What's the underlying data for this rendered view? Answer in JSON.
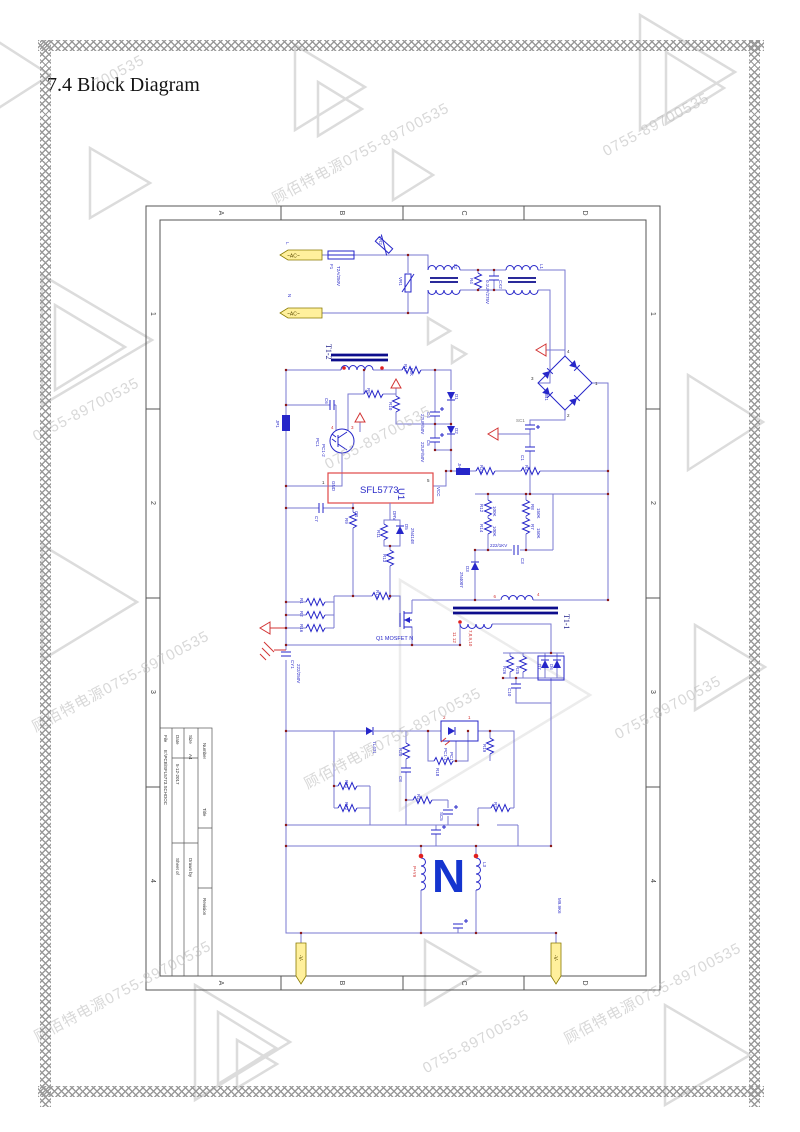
{
  "page": {
    "title": "7.4 Block Diagram"
  },
  "watermark": {
    "text": "顾佰特电源0755-89700535",
    "short": "0755-89700535",
    "frag": "700535"
  },
  "frame": {
    "cols": [
      "A",
      "B",
      "C",
      "D"
    ],
    "rows": [
      "1",
      "2",
      "3",
      "4"
    ]
  },
  "title_block": {
    "title_label": "Title",
    "size_label": "Size",
    "size": "A4",
    "number_label": "Number",
    "revision_label": "Revision",
    "date_label": "Date",
    "date": "5-12-2017",
    "sheet_label": "Sheet of",
    "file_label": "File",
    "file": "E:\\PCB\\SFL5773.SCHDOC",
    "drawn_label": "Drawn by"
  },
  "sch": {
    "acL": "L",
    "acN": "N",
    "ac": "~AC~",
    "f1": "F1",
    "f1v": "T2A/250V",
    "vr2": "VR2",
    "vr1": "VR1",
    "l2": "L2",
    "r4": "R4",
    "cx2": "CX2",
    "cx2v": "0.1UF/275V",
    "l1": "L1",
    "db1": "DB1",
    "bp1": "1",
    "bp2": "2",
    "bp3": "3",
    "bp4": "4",
    "sc1": "SC1",
    "c1": "C1",
    "t12": "T1-2",
    "jp1": "JP1",
    "c6": "C6",
    "pc1": "PC1",
    "pc12": "PC1-2",
    "op4": "4",
    "op3": "3",
    "r17": "R17",
    "r17v": "56K",
    "r5": "R5",
    "r10": "R10",
    "c4": "C4",
    "c4v": "22UF/50V",
    "c5": "C5",
    "c5v": "22UF/50V",
    "d1": "D1",
    "d2": "D2",
    "u1": "U1",
    "u1n": "SFL5773",
    "gnd": "GND",
    "vcc": "VCC",
    "cs": "CS",
    "drv": "DRV",
    "p1": "1",
    "p5": "5",
    "c7": "C7",
    "r9": "R9",
    "r11": "R11",
    "d5": "D5",
    "d5v": "2N4148",
    "r13": "R13",
    "r15": "R15",
    "r1": "R1",
    "r2": "R2",
    "r16": "R16",
    "jh1": "JH1",
    "r24": "R24",
    "r3": "R3",
    "r12": "R12",
    "r12v": "100K",
    "r14": "R14",
    "r14v": "100K",
    "r8": "R8",
    "r8v": "150K",
    "r7": "R7",
    "r7v": "150K",
    "c3": "C3",
    "c3v": "222/1KV",
    "d3": "D3",
    "d3v": "2N4007",
    "q1": "Q1 MOSFET N",
    "cy1": "CY1",
    "cy1v": "222/250V",
    "t11": "T1-1",
    "tp6": "6",
    "tp4": "4",
    "sec1": "11 12",
    "sec2": "7,8,9,10",
    "r26": "R26",
    "r25": "R25",
    "d7": "D7",
    "d6": "D6",
    "c10": "C10",
    "r19": "R19",
    "pc11": "PC1-1",
    "pc1b": "PC1",
    "op2": "2",
    "op1": "1",
    "r18": "R18",
    "u2": "TL431",
    "r20": "R20",
    "c8": "C8",
    "r21": "R21",
    "r22": "R22",
    "r23": "R23",
    "sc5": "SC5",
    "r27": "R27",
    "py9": "P+Y9",
    "logo": "N",
    "l3": "L3",
    "net1": "M9.9K6",
    "vneg": "-V-"
  }
}
